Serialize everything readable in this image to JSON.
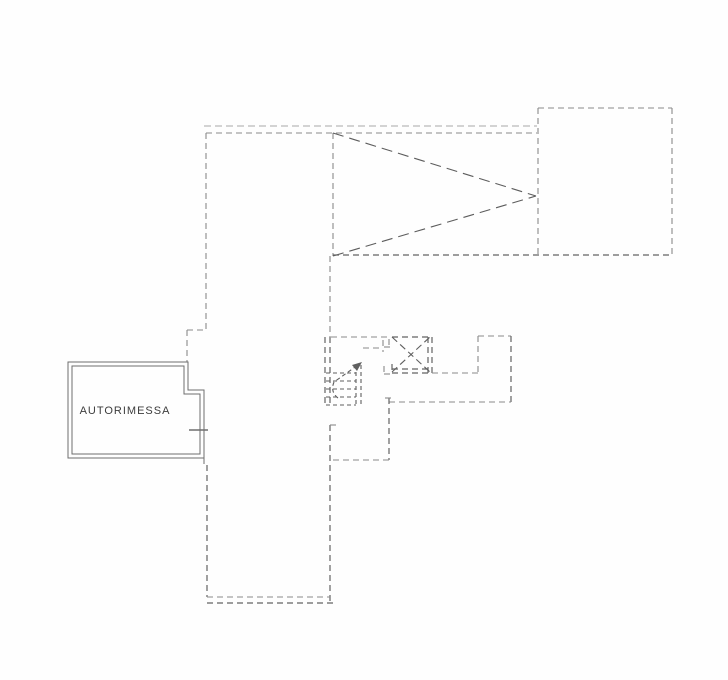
{
  "document": {
    "type": "scanned-floor-plan",
    "background": "#fefefe"
  },
  "room_label": {
    "text": "AUTORIMESSA",
    "x": 125,
    "y": 414,
    "font_size": 11,
    "letter_spacing": 1,
    "color": "#3c3c3c"
  },
  "styles": {
    "light": {
      "color": "#a8a8a8",
      "width": 1.0,
      "dash": "7 4"
    },
    "med": {
      "color": "#8a8a8a",
      "width": 1.1,
      "dash": "6 4"
    },
    "dark": {
      "color": "#636363",
      "width": 1.2,
      "dash": "6 4"
    },
    "diag": {
      "color": "#5c5c5c",
      "width": 1.1,
      "dash": "11 6"
    },
    "cross": {
      "color": "#5f5f5f",
      "width": 1.1,
      "dash": "7 4"
    },
    "step": {
      "color": "#5f5f5f",
      "width": 1.1,
      "dash": "4 3"
    },
    "solid": {
      "color": "#6e6e6e",
      "width": 1.0,
      "dash": ""
    },
    "sill": {
      "color": "#6e6e6e",
      "width": 1.5,
      "dash": ""
    }
  },
  "floorplan": {
    "segments": [
      {
        "x1": 204,
        "y1": 126,
        "x2": 537,
        "y2": 126,
        "s": "light",
        "name": "upper-roof-line-outer"
      },
      {
        "x1": 206,
        "y1": 133,
        "x2": 537,
        "y2": 133,
        "s": "med",
        "name": "upper-roof-line-inner"
      },
      {
        "x1": 206,
        "y1": 133,
        "x2": 206,
        "y2": 330,
        "s": "med",
        "name": "left-wall-upper"
      },
      {
        "x1": 187,
        "y1": 330,
        "x2": 206,
        "y2": 330,
        "s": "med",
        "name": "left-jog-horizontal"
      },
      {
        "x1": 187,
        "y1": 330,
        "x2": 187,
        "y2": 362,
        "s": "med",
        "name": "left-jog-vertical"
      },
      {
        "x1": 333,
        "y1": 133,
        "x2": 333,
        "y2": 256,
        "s": "med",
        "name": "gable-left-edge"
      },
      {
        "x1": 333,
        "y1": 133,
        "x2": 536,
        "y2": 196,
        "s": "diag",
        "name": "gable-diagonal-top"
      },
      {
        "x1": 333,
        "y1": 256,
        "x2": 536,
        "y2": 196,
        "s": "diag",
        "name": "gable-diagonal-bottom"
      },
      {
        "x1": 538,
        "y1": 108,
        "x2": 672,
        "y2": 108,
        "s": "med",
        "name": "annex-top-wall"
      },
      {
        "x1": 672,
        "y1": 108,
        "x2": 672,
        "y2": 255,
        "s": "med",
        "name": "annex-right-wall"
      },
      {
        "x1": 538,
        "y1": 108,
        "x2": 538,
        "y2": 255,
        "s": "med",
        "name": "annex-left-wall"
      },
      {
        "x1": 333,
        "y1": 255,
        "x2": 672,
        "y2": 255,
        "s": "dark",
        "name": "upper-bottom-edge"
      },
      {
        "x1": 330,
        "y1": 256,
        "x2": 330,
        "y2": 337,
        "s": "med",
        "name": "spine-wall-upper"
      },
      {
        "x1": 325,
        "y1": 337,
        "x2": 325,
        "y2": 405,
        "s": "dark",
        "name": "stair-wall-outer"
      },
      {
        "x1": 330,
        "y1": 337,
        "x2": 330,
        "y2": 405,
        "s": "dark",
        "name": "stair-wall-inner"
      },
      {
        "x1": 330,
        "y1": 425,
        "x2": 330,
        "y2": 603,
        "s": "dark",
        "name": "corridor-right-wall"
      },
      {
        "x1": 330,
        "y1": 425,
        "x2": 337,
        "y2": 425,
        "s": "med",
        "name": "door-jamb-tick"
      },
      {
        "x1": 331,
        "y1": 337,
        "x2": 388,
        "y2": 337,
        "s": "med",
        "name": "middle-top-wall"
      },
      {
        "x1": 389,
        "y1": 339,
        "x2": 389,
        "y2": 347,
        "s": "med",
        "name": "jamb-stub-vertical"
      },
      {
        "x1": 384,
        "y1": 347,
        "x2": 392,
        "y2": 347,
        "s": "med",
        "name": "jamb-stub-horizontal"
      },
      {
        "x1": 392,
        "y1": 337,
        "x2": 430,
        "y2": 337,
        "s": "dark",
        "name": "shaft-top-wall"
      },
      {
        "x1": 392,
        "y1": 364,
        "x2": 392,
        "y2": 373,
        "s": "dark",
        "name": "shaft-left-wall"
      },
      {
        "x1": 428,
        "y1": 337,
        "x2": 428,
        "y2": 373,
        "s": "dark",
        "name": "shaft-right-wall-inner"
      },
      {
        "x1": 432,
        "y1": 337,
        "x2": 432,
        "y2": 373,
        "s": "dark",
        "name": "shaft-right-wall-outer"
      },
      {
        "x1": 392,
        "y1": 369,
        "x2": 428,
        "y2": 369,
        "s": "dark",
        "name": "shaft-bottom-wall-inner"
      },
      {
        "x1": 392,
        "y1": 373,
        "x2": 430,
        "y2": 373,
        "s": "dark",
        "name": "shaft-bottom-wall-outer"
      },
      {
        "x1": 392,
        "y1": 337,
        "x2": 430,
        "y2": 372,
        "s": "cross",
        "name": "shaft-cross-diagonal-1"
      },
      {
        "x1": 392,
        "y1": 372,
        "x2": 430,
        "y2": 337,
        "s": "cross",
        "name": "shaft-cross-diagonal-2"
      },
      {
        "x1": 384,
        "y1": 366,
        "x2": 384,
        "y2": 374,
        "s": "med",
        "name": "shaft-jamb-left-vertical"
      },
      {
        "x1": 384,
        "y1": 374,
        "x2": 392,
        "y2": 374,
        "s": "med",
        "name": "shaft-jamb-left-horizontal"
      },
      {
        "x1": 432,
        "y1": 373,
        "x2": 478,
        "y2": 373,
        "s": "med",
        "name": "landing-step-wall"
      },
      {
        "x1": 478,
        "y1": 336,
        "x2": 478,
        "y2": 373,
        "s": "med",
        "name": "landing-left-wall"
      },
      {
        "x1": 478,
        "y1": 336,
        "x2": 511,
        "y2": 336,
        "s": "med",
        "name": "landing-top-wall"
      },
      {
        "x1": 511,
        "y1": 336,
        "x2": 511,
        "y2": 402,
        "s": "dark",
        "name": "landing-right-wall"
      },
      {
        "x1": 389,
        "y1": 402,
        "x2": 511,
        "y2": 402,
        "s": "med",
        "name": "landing-bottom-wall"
      },
      {
        "x1": 389,
        "y1": 398,
        "x2": 389,
        "y2": 460,
        "s": "dark",
        "name": "lower-right-wall"
      },
      {
        "x1": 385,
        "y1": 398,
        "x2": 393,
        "y2": 398,
        "s": "med",
        "name": "lower-jamb-tick"
      },
      {
        "x1": 333,
        "y1": 460,
        "x2": 389,
        "y2": 460,
        "s": "med",
        "name": "lower-bottom-wall"
      },
      {
        "x1": 207,
        "y1": 465,
        "x2": 207,
        "y2": 597,
        "s": "dark",
        "name": "corridor-left-wall"
      },
      {
        "x1": 207,
        "y1": 597,
        "x2": 330,
        "y2": 597,
        "s": "med",
        "name": "corridor-bottom-inner"
      },
      {
        "x1": 207,
        "y1": 603,
        "x2": 334,
        "y2": 603,
        "s": "dark",
        "name": "corridor-bottom-outer"
      },
      {
        "x1": 326,
        "y1": 373,
        "x2": 356,
        "y2": 373,
        "s": "step",
        "name": "stair-tread-1"
      },
      {
        "x1": 326,
        "y1": 381,
        "x2": 356,
        "y2": 381,
        "s": "step",
        "name": "stair-tread-2"
      },
      {
        "x1": 326,
        "y1": 389,
        "x2": 356,
        "y2": 389,
        "s": "step",
        "name": "stair-tread-3"
      },
      {
        "x1": 326,
        "y1": 397,
        "x2": 356,
        "y2": 397,
        "s": "step",
        "name": "stair-tread-4"
      },
      {
        "x1": 326,
        "y1": 405,
        "x2": 356,
        "y2": 405,
        "s": "step",
        "name": "stair-tread-5"
      },
      {
        "x1": 356,
        "y1": 365,
        "x2": 356,
        "y2": 405,
        "s": "step",
        "name": "stair-right-edge-inner"
      },
      {
        "x1": 361,
        "y1": 365,
        "x2": 361,
        "y2": 405,
        "s": "step",
        "name": "stair-right-edge-outer"
      },
      {
        "x1": 363,
        "y1": 348,
        "x2": 383,
        "y2": 348,
        "s": "med",
        "name": "stair-top-wall"
      },
      {
        "x1": 383,
        "y1": 340,
        "x2": 383,
        "y2": 352,
        "s": "med",
        "name": "stair-top-jamb"
      },
      {
        "x1": 189,
        "y1": 430,
        "x2": 208,
        "y2": 430,
        "s": "sill",
        "name": "garage-door-sill"
      },
      {
        "x1": 204,
        "y1": 458,
        "x2": 204,
        "y2": 464,
        "s": "solid",
        "name": "garage-wall-step-down"
      }
    ],
    "polygons": [
      {
        "points": "68,362 188,362 188,390 204,390 204,458 68,458",
        "s": "solid",
        "name": "garage-outer-wall"
      },
      {
        "points": "72,366 184,366 184,394 200,394 200,454 72,454",
        "s": "solid",
        "name": "garage-inner-wall"
      }
    ],
    "paths": [
      {
        "d": "M338,398 Q330,392 334,382 L358,365",
        "s": "step",
        "name": "stair-direction-arrow"
      }
    ],
    "arrowhead": {
      "points": "362,362 352,365 357,371",
      "color": "#5f5f5f",
      "name": "stair-arrow-head"
    }
  }
}
